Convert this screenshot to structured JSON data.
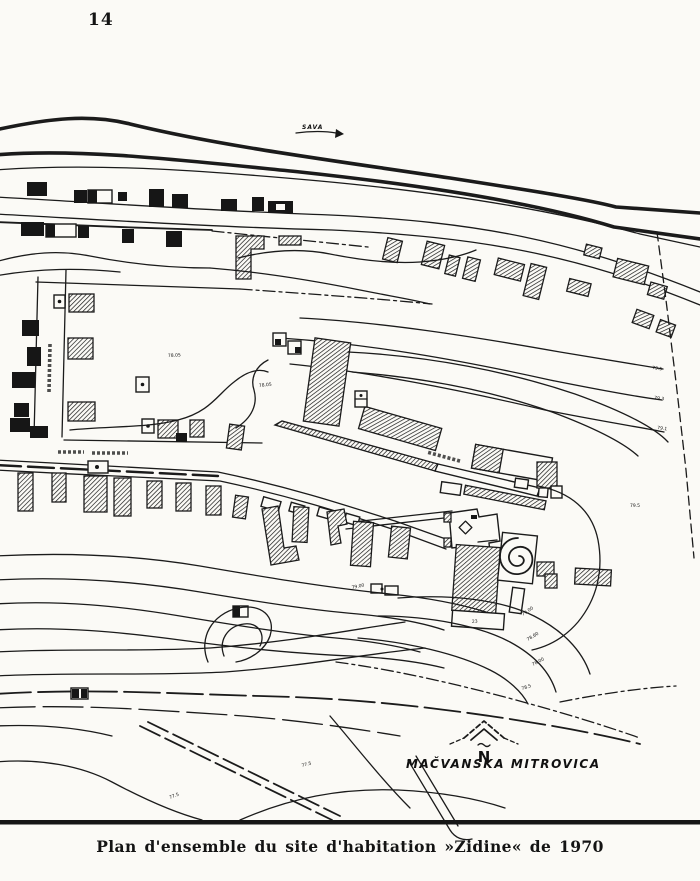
{
  "page": {
    "number": "14",
    "caption": "Plan d'ensemble du site d'habitation »Zidine« de 1970"
  },
  "map": {
    "river_label": "SAVA",
    "north_label": "N",
    "place_label": "MAČVANSKA MITROVICA",
    "site_name": "Zidine",
    "building_number": "23",
    "elevation_labels": [
      "78.05",
      "78.05",
      "79.5",
      "79.3",
      "79.1",
      "79.5",
      "79.00",
      "79.00",
      "78.60",
      "78.00",
      "78.5",
      "77.5",
      "77.5"
    ]
  }
}
